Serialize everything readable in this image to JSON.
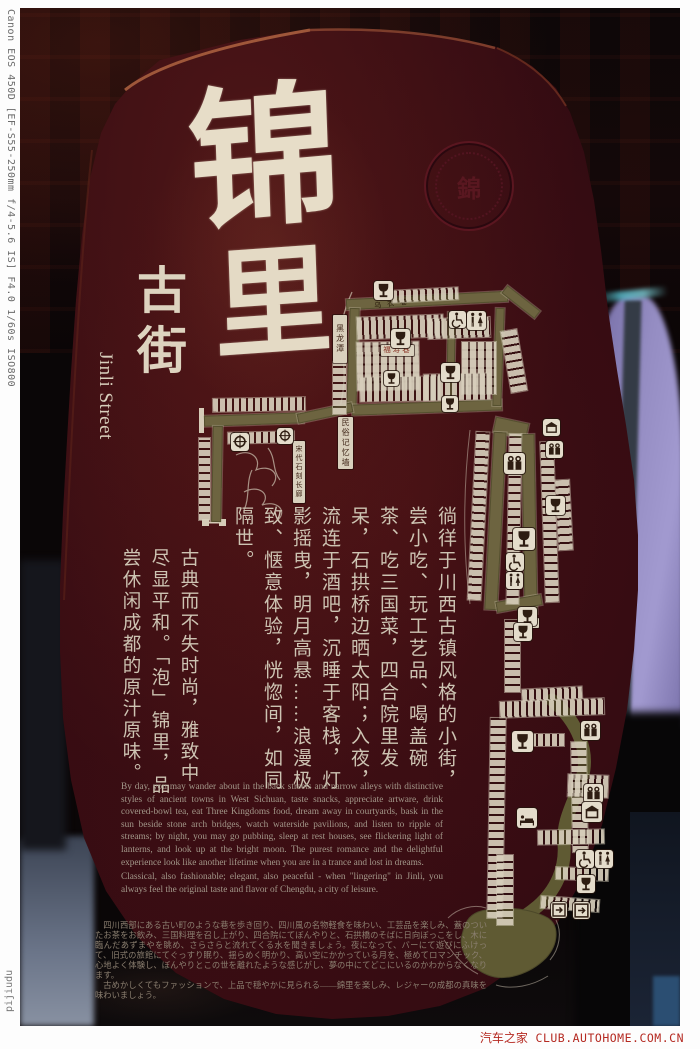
{
  "frame": {
    "exif": "Canon EOS 450D [EF-S55-250mm f/4-5.6 IS] F4.0 1/60s ISO800",
    "author": "pijiudu",
    "watermark_cn": "汽车之家",
    "watermark_site": "CLUB.AUTOHOME.COM.CN"
  },
  "board": {
    "title": {
      "char1": "锦",
      "char2": "里",
      "sub": "古街",
      "en": "Jinli Street",
      "seal_glyph": "錦"
    },
    "paragraphs": {
      "cn_main": "徜徉于川西古镇风格的小街，尝小吃、玩工艺品、喝盖碗茶、吃三国菜，四合院里发呆，石拱桥边晒太阳；入夜，流连于酒吧，沉睡于客栈，灯影摇曳，明月高悬……浪漫极致、惬意体验，恍惚间，如同隔世。",
      "cn_sub": "古典而不失时尚，雅致中尽显平和。「泡」锦里，品尝休闲成都的原汁原味。",
      "en_1": "By day, you may wander about in the back streets and narrow alleys with distinctive styles of ancient towns in West Sichuan, taste snacks, appreciate artware, drink covered-bowl tea, eat Three Kingdoms food, dream away in courtyards, bask in the sun beside stone arch bridges, watch waterside pavilions, and listen to ripple of streams; by night, you may go pubbing, sleep at rest houses, see flickering light of lanterns, and look up at the bright moon. The purest romance and the delightful experience look like another lifetime when you are in a trance and lost in dreams.",
      "en_2": "Classical, also fashionable; elegant, also peaceful - when \"lingering\" in Jinli, you always feel the original taste and flavor of Chengdu, a city of leisure.",
      "jp_1": "四川西部にある古い町のような巷を歩き回り、四川風の名物軽食を味わい、工芸品を楽しみ、蓋のついたお茶をお飲み、三国料理を召し上がり、四合院にてぼんやりと、石拱橋のそばに日向ぼっこをし、木に臨んだあずまやを眺め、さらさらと流れてくる水を聞きましょう。夜になって、バーにて遊びにふけって、旧式の旅館にてぐっすり眠り、揺らめく明かり、高い空にかかっている月を、極めてロマンチック、心地よく体験し、ぼんやりとこの世を離れたような感じがし、夢の中にてどこにいるのかわからなくなります。",
      "jp_2": "古めかしくてもファッションで、上品で穏やかに見られる——錦里を楽しみ、レジャーの成都の真味を味わいましょう。"
    },
    "map": {
      "labels": {
        "heilongtan": "黑龙潭",
        "wuyixiang": "乌衣巷",
        "fushouxiang": "福寿巷",
        "minsu": "民俗记忆墙",
        "songdai": "宋代石刻长廊",
        "xitai": "戏台"
      },
      "icon_types": [
        "goblet",
        "gift",
        "drum",
        "wheelchair",
        "restroom",
        "bed",
        "shop",
        "exit"
      ]
    },
    "colors": {
      "board": "#330b12",
      "ink": "#e7ddc8",
      "map_path": "#6d6440",
      "map_white": "#d6ccb8",
      "watermark_red": "#b52a22"
    }
  }
}
